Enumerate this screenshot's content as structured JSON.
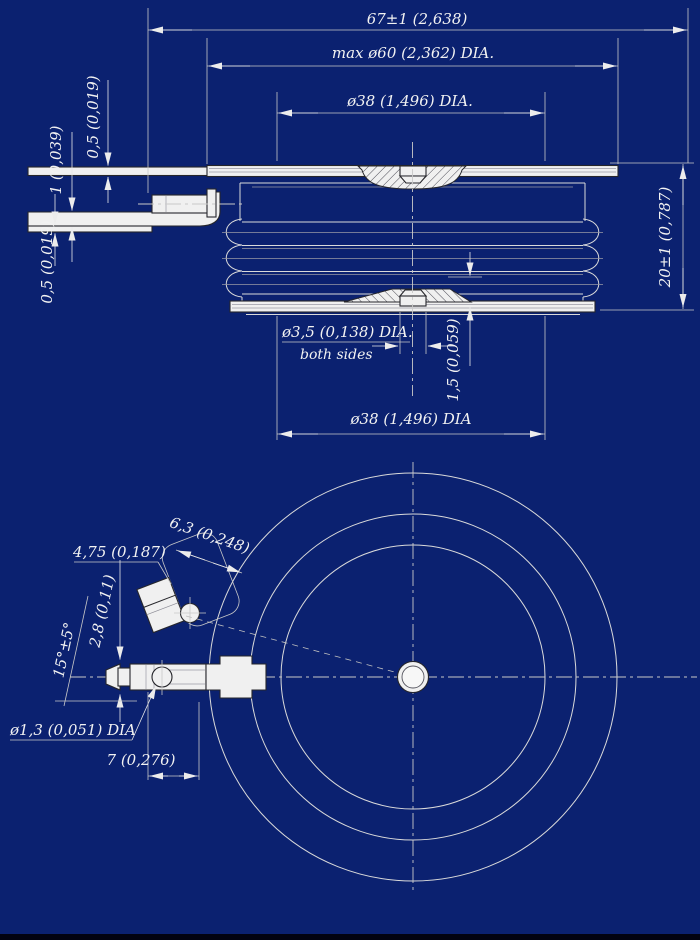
{
  "colors": {
    "background": "#0b2170",
    "line": "#dadada",
    "text": "#f2f2f2",
    "shape_fill": "#f0f0f0"
  },
  "labels": {
    "dim_overall_width": "67±1 (2,638)",
    "dim_max_dia": "max ø60 (2,362) DIA.",
    "dim_contact_dia_top": "ø38 (1,496) DIA.",
    "dim_lead_thickness_top": "0,5 (0,019)",
    "dim_lead_thickness_mid": "1 (0,039)",
    "dim_lead_thickness_bottom": "0,5 (0,019)",
    "dim_height": "20±1 (0,787)",
    "dim_gate_hole": "ø3,5 (0,138) DIA.",
    "dim_gate_hole_note": "both sides",
    "dim_recess_depth": "1,5 (0,059)",
    "dim_contact_dia_bottom": "ø38 (1,496) DIA",
    "dim_tab_width": "4,75 (0,187)",
    "dim_connector_width": "6,3 (0,248)",
    "dim_tab_offset": "2,8 (0,11)",
    "dim_angle": "15°±5°",
    "dim_pin_hole": "ø1,3 (0,051) DIA",
    "dim_pin_length": "7 (0,276)"
  }
}
